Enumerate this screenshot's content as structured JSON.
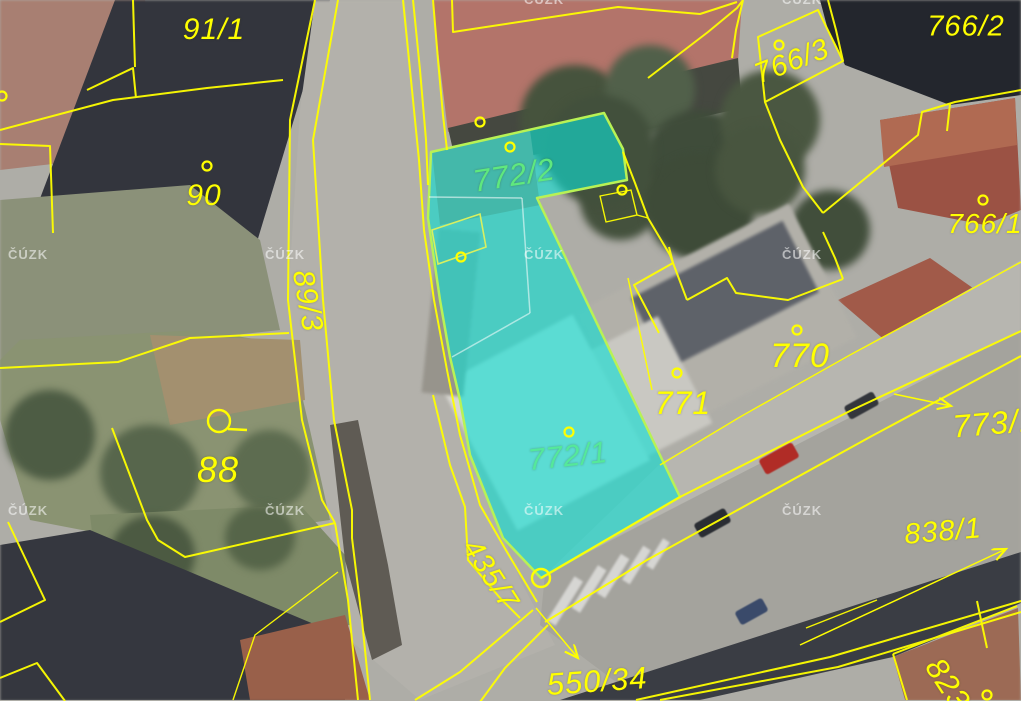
{
  "app": {
    "name": "cadastral-map-view",
    "watermark_text": "ČÚZK"
  },
  "map": {
    "selected_parcels": [
      "772/2",
      "772/1"
    ],
    "highlight_fill": "#0EDED4",
    "highlight_edge": "#B8F255",
    "boundary_color": "#FFFF00",
    "labels": [
      {
        "text": "91/1",
        "x": 214,
        "y": 30,
        "rot": 0,
        "size": 30,
        "color": "#FFFF00"
      },
      {
        "text": "90",
        "x": 204,
        "y": 196,
        "rot": 0,
        "size": 30,
        "color": "#FFFF00"
      },
      {
        "text": "766/2",
        "x": 966,
        "y": 27,
        "rot": 0,
        "size": 29,
        "color": "#FFFF00"
      },
      {
        "text": "766/3",
        "x": 792,
        "y": 62,
        "rot": -21,
        "size": 29,
        "color": "#FFFF00"
      },
      {
        "text": "766/1",
        "x": 985,
        "y": 224,
        "rot": 0,
        "size": 28,
        "color": "#FFFF00"
      },
      {
        "text": "89/3",
        "x": 307,
        "y": 301,
        "rot": 80,
        "size": 30,
        "color": "#FFFF00"
      },
      {
        "text": "772/2",
        "x": 514,
        "y": 175,
        "rot": -9,
        "size": 31,
        "color": "#5FE87E"
      },
      {
        "text": "770",
        "x": 800,
        "y": 356,
        "rot": 0,
        "size": 34,
        "color": "#FFFF00"
      },
      {
        "text": "771",
        "x": 683,
        "y": 403,
        "rot": 0,
        "size": 32,
        "color": "#FFFF00"
      },
      {
        "text": "772/1",
        "x": 568,
        "y": 457,
        "rot": -6,
        "size": 30,
        "color": "#55E89A"
      },
      {
        "text": "88",
        "x": 218,
        "y": 470,
        "rot": 0,
        "size": 36,
        "color": "#FFFF00"
      },
      {
        "text": "435/7",
        "x": 490,
        "y": 575,
        "rot": 57,
        "size": 29,
        "color": "#FFFF00"
      },
      {
        "text": "550/34",
        "x": 597,
        "y": 681,
        "rot": -4,
        "size": 31,
        "color": "#FFFF00"
      },
      {
        "text": "773/1",
        "x": 995,
        "y": 423,
        "rot": -5,
        "size": 32,
        "color": "#FFFF00"
      },
      {
        "text": "838/1",
        "x": 943,
        "y": 532,
        "rot": -5,
        "size": 29,
        "color": "#FFFF00"
      },
      {
        "text": "823",
        "x": 948,
        "y": 684,
        "rot": 57,
        "size": 31,
        "color": "#FFFF00"
      }
    ],
    "point_markers": [
      {
        "x": 207,
        "y": 166
      },
      {
        "x": 480,
        "y": 122
      },
      {
        "x": 510,
        "y": 147
      },
      {
        "x": 622,
        "y": 190
      },
      {
        "x": 461,
        "y": 257
      },
      {
        "x": 779,
        "y": 45
      },
      {
        "x": 983,
        "y": 200
      },
      {
        "x": 797,
        "y": 330
      },
      {
        "x": 677,
        "y": 373
      },
      {
        "x": 569,
        "y": 432
      },
      {
        "x": 987,
        "y": 695
      },
      {
        "x": 2,
        "y": 96
      }
    ],
    "big_circles": [
      {
        "x": 541,
        "y": 578,
        "r": 9
      },
      {
        "x": 219,
        "y": 421,
        "r": 11,
        "tail_x2": 247,
        "tail_y2": 430
      }
    ],
    "arrows": [
      {
        "x1": 536,
        "y1": 608,
        "x2": 578,
        "y2": 658,
        "points_to": "550/34"
      },
      {
        "x1": 800,
        "y1": 645,
        "x2": 1006,
        "y2": 549,
        "points_to": "838/1"
      },
      {
        "x1": 894,
        "y1": 394,
        "x2": 951,
        "y2": 406,
        "points_to": "773/1"
      }
    ],
    "watermarks": [
      {
        "x": 8,
        "y": 247
      },
      {
        "x": 265,
        "y": 247
      },
      {
        "x": 524,
        "y": 247
      },
      {
        "x": 782,
        "y": 247
      },
      {
        "x": 8,
        "y": 503
      },
      {
        "x": 265,
        "y": 503
      },
      {
        "x": 524,
        "y": 503
      },
      {
        "x": 782,
        "y": 503
      },
      {
        "x": 524,
        "y": -8
      },
      {
        "x": 782,
        "y": -8
      }
    ]
  }
}
